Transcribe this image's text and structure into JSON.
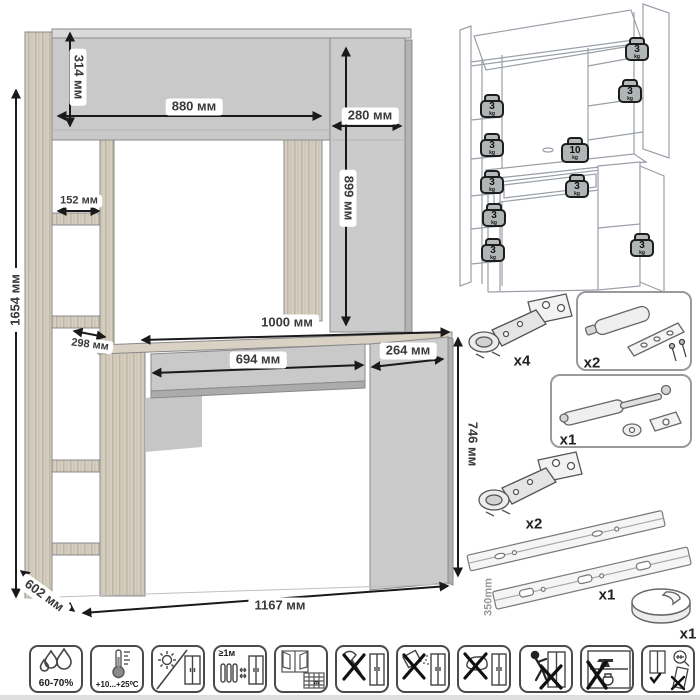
{
  "main_drawing": {
    "dims": {
      "total_height": "1654 мм",
      "hutch_height": "314 мм",
      "hutch_width": "880 мм",
      "right_cabinet_width": "280 мм",
      "right_cabinet_height": "899 мм",
      "shelf_width": "152 мм",
      "shelf_depth": "298 мм",
      "desktop_width": "1000 мм",
      "drawer_width": "694 мм",
      "pedestal_width": "264 мм",
      "desk_height": "746 мм",
      "depth": "602 мм",
      "total_width": "1167 мм"
    }
  },
  "load_diagram": {
    "unit": "kg",
    "weights": [
      {
        "value": "3"
      },
      {
        "value": "3"
      },
      {
        "value": "3"
      },
      {
        "value": "3"
      },
      {
        "value": "3"
      },
      {
        "value": "3"
      },
      {
        "value": "3"
      },
      {
        "value": "10"
      },
      {
        "value": "3"
      },
      {
        "value": "3"
      }
    ]
  },
  "hardware": {
    "items": [
      {
        "name": "cabinet hinge",
        "qty": "x4"
      },
      {
        "name": "door damper kit",
        "qty": "x2"
      },
      {
        "name": "gas lift",
        "qty": "x1"
      },
      {
        "name": "cabinet hinge",
        "qty": "x2"
      },
      {
        "name": "ball-bearing drawer slides",
        "qty": "x1",
        "length": "350mm"
      },
      {
        "name": "cable grommet",
        "qty": "x1"
      }
    ]
  },
  "care": {
    "humidity": "60-70%",
    "temperature": "+10...+25⁰C",
    "heat_distance": "≥1м",
    "calendar_day": "21"
  }
}
